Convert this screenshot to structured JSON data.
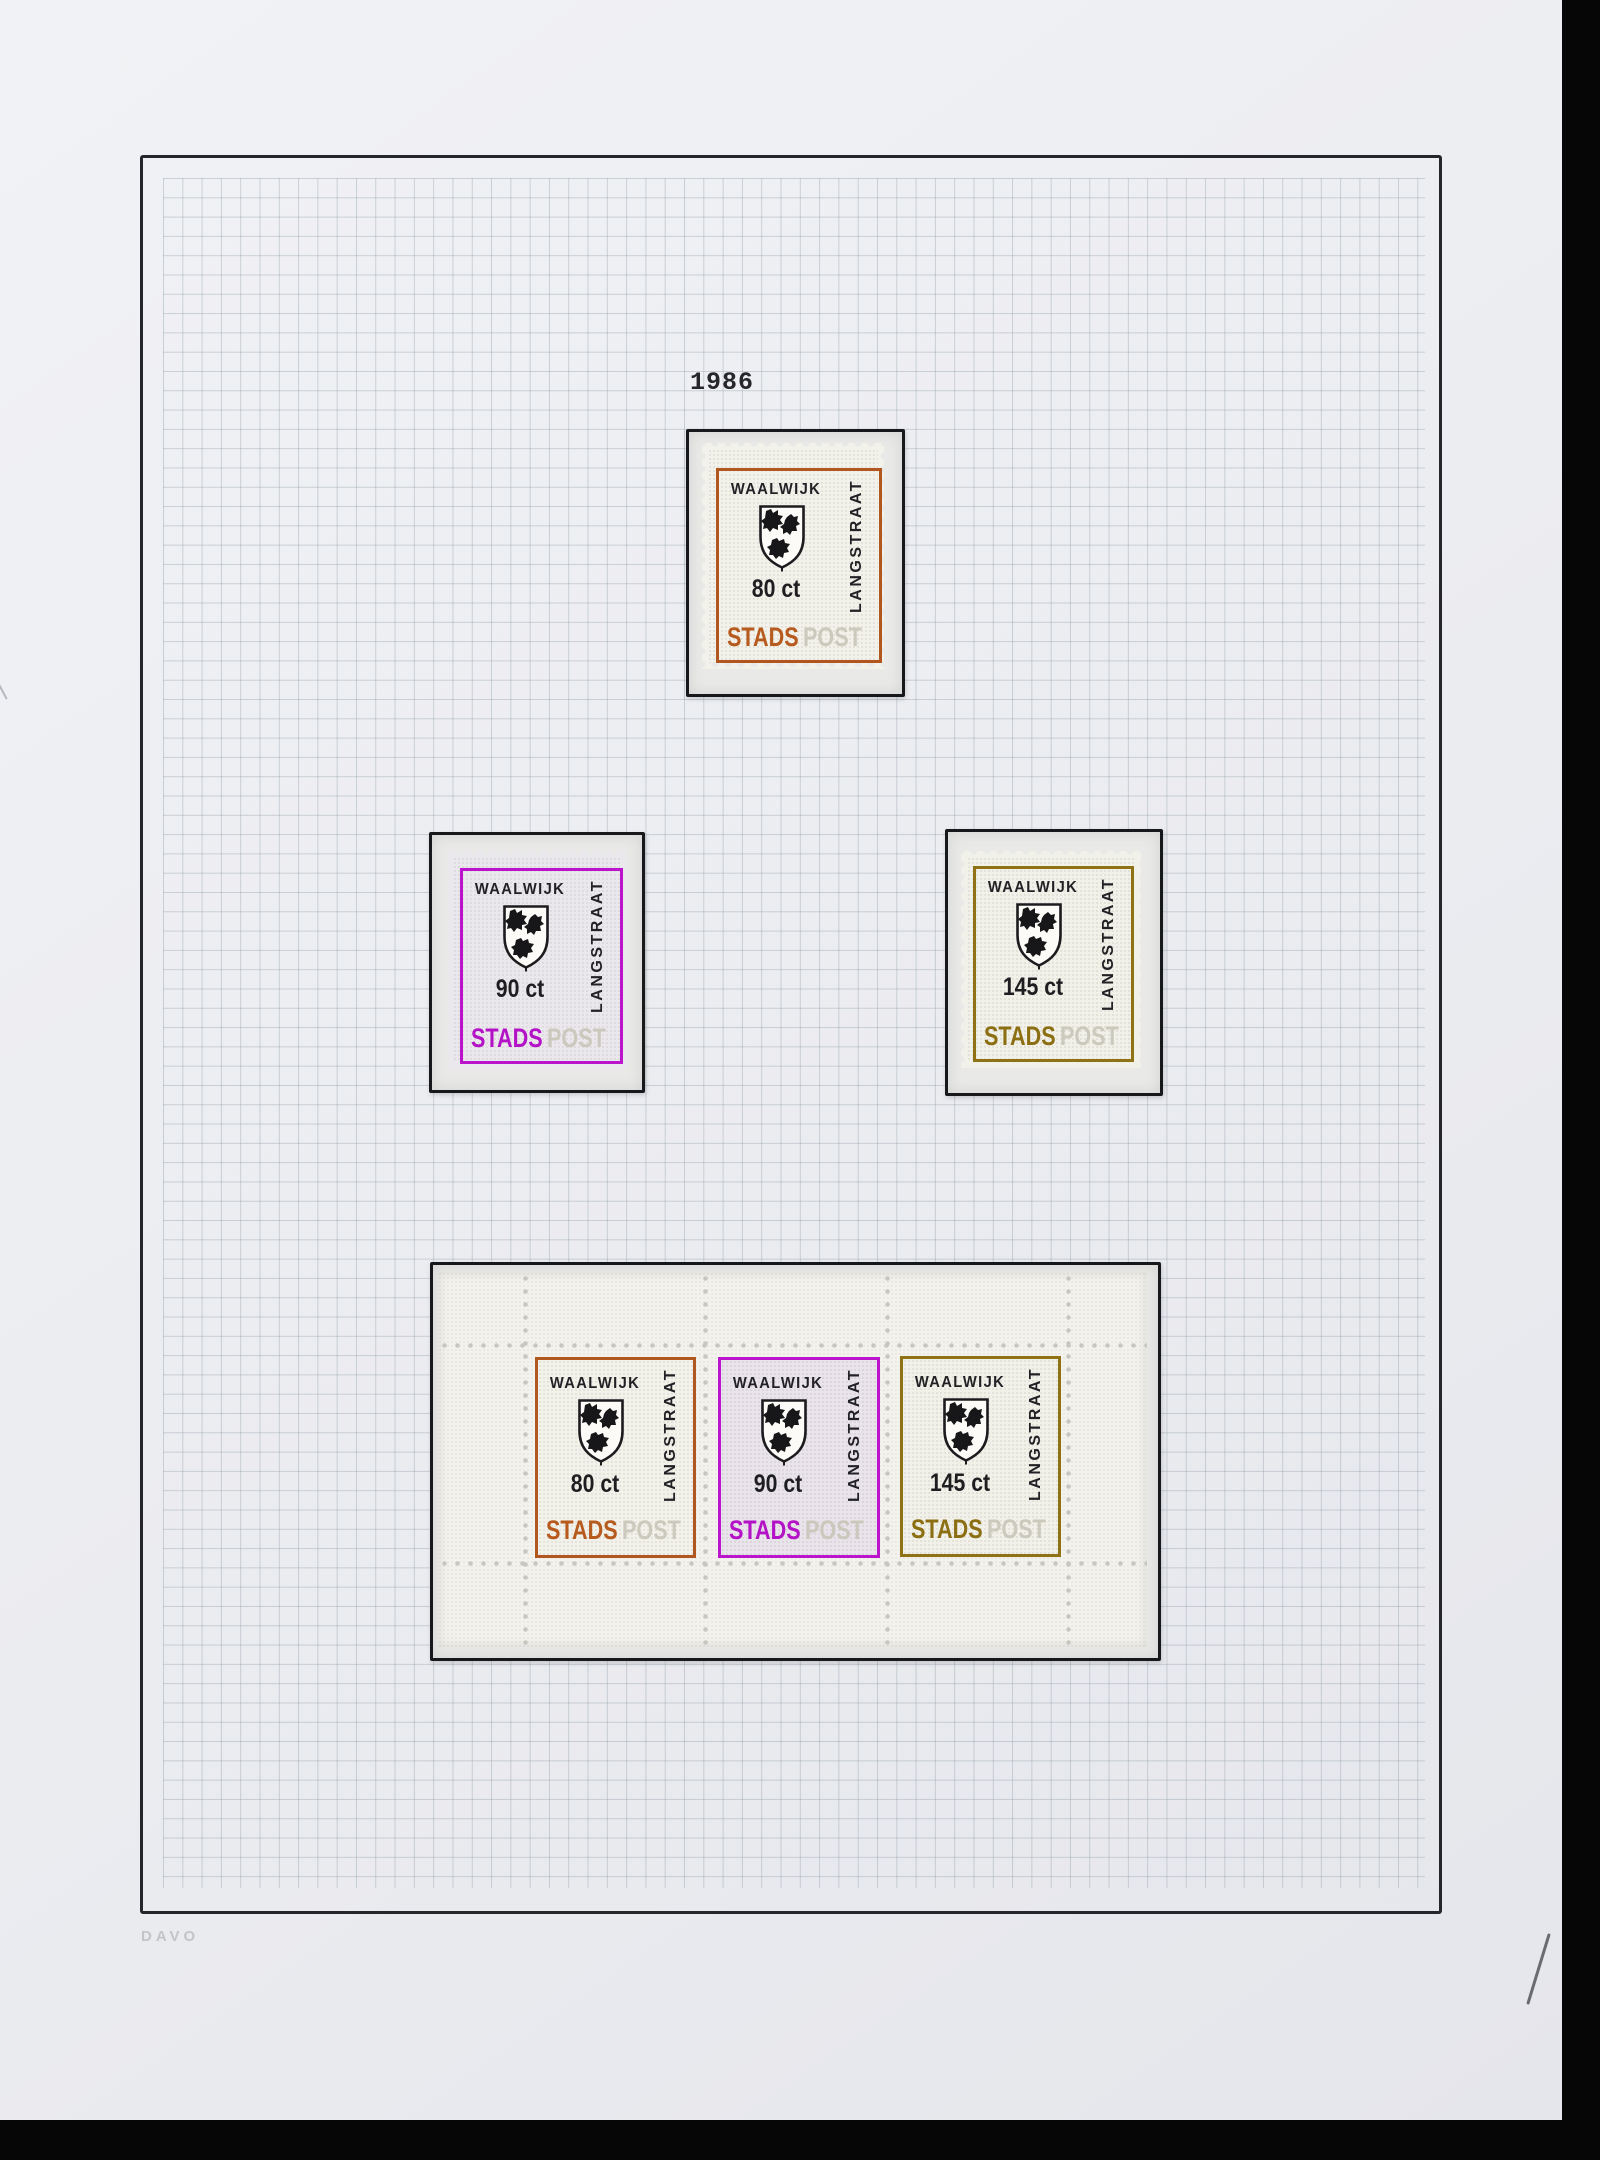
{
  "page": {
    "year_label": "1986",
    "brand_label": "DAVO",
    "handwritten_mark": "/"
  },
  "colors": {
    "orange_frame": "#b0561e",
    "magenta_frame": "#ba14cc",
    "olive_frame": "#8e7213",
    "mount_border": "#17181c",
    "ghost_post_text": "#c9c6bb",
    "grid_line": "#8f9ea6"
  },
  "stamps": {
    "singles": [
      {
        "city": "WAALWIJK",
        "region": "LANGSTRAAT",
        "value": "80 ct",
        "stads": "STADS",
        "post": "POST",
        "color": "orange"
      },
      {
        "city": "WAALWIJK",
        "region": "LANGSTRAAT",
        "value": "90 ct",
        "stads": "STADS",
        "post": "POST",
        "color": "magenta"
      },
      {
        "city": "WAALWIJK",
        "region": "LANGSTRAAT",
        "value": "145 ct",
        "stads": "STADS",
        "post": "POST",
        "color": "olive"
      }
    ],
    "sheet": [
      {
        "city": "WAALWIJK",
        "region": "LANGSTRAAT",
        "value": "80 ct",
        "stads": "STADS",
        "post": "POST",
        "color": "orange"
      },
      {
        "city": "WAALWIJK",
        "region": "LANGSTRAAT",
        "value": "90 ct",
        "stads": "STADS",
        "post": "POST",
        "color": "magenta"
      },
      {
        "city": "WAALWIJK",
        "region": "LANGSTRAAT",
        "value": "145 ct",
        "stads": "STADS",
        "post": "POST",
        "color": "olive"
      }
    ]
  }
}
